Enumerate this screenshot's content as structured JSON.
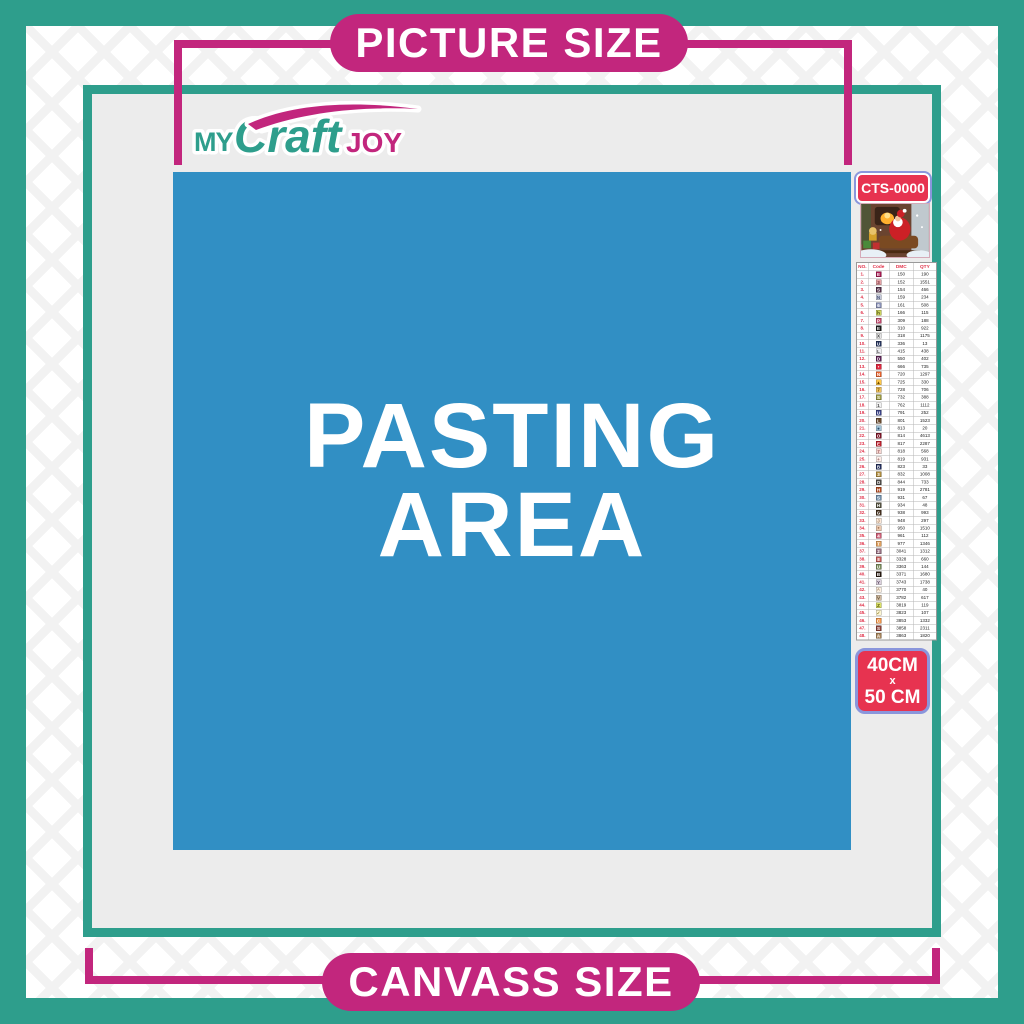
{
  "banners": {
    "top": "PICTURE SIZE",
    "bottom": "CANVASS SIZE"
  },
  "logo": {
    "my": "MY",
    "craft": "Craft",
    "joy": "JOY"
  },
  "pasting_area": {
    "line1": "PASTING",
    "line2": "AREA"
  },
  "sidebar": {
    "sku": "CTS-0000",
    "thumbnail_alt": "christmas-santa-sleigh-artwork",
    "size": {
      "line1": "40CM",
      "line2": "x",
      "line3": "50 CM"
    },
    "table": {
      "headers": [
        "NO.",
        "Code",
        "DMC",
        "QTY"
      ],
      "rows": [
        {
          "no": "1.",
          "symbol": "E",
          "bg": "#a81a52",
          "fg": "#ffffff",
          "dmc": "150",
          "qty": "190"
        },
        {
          "no": "2.",
          "symbol": "3",
          "bg": "#e5a3a6",
          "fg": "#7a3a44",
          "dmc": "152",
          "qty": "1551"
        },
        {
          "no": "3.",
          "symbol": "S",
          "bg": "#53304a",
          "fg": "#ffffff",
          "dmc": "154",
          "qty": "466"
        },
        {
          "no": "4.",
          "symbol": "N",
          "bg": "#c6cbdc",
          "fg": "#4a5578",
          "dmc": "159",
          "qty": "234"
        },
        {
          "no": "5.",
          "symbol": "6",
          "bg": "#8a92b8",
          "fg": "#ffffff",
          "dmc": "161",
          "qty": "508"
        },
        {
          "no": "6.",
          "symbol": "h",
          "bg": "#ccd45e",
          "fg": "#4a4a12",
          "dmc": "166",
          "qty": "115"
        },
        {
          "no": "7.",
          "symbol": "P",
          "bg": "#c24a6e",
          "fg": "#ffffff",
          "dmc": "309",
          "qty": "188"
        },
        {
          "no": "8.",
          "symbol": "E",
          "bg": "#1c1c1c",
          "fg": "#ffffff",
          "dmc": "310",
          "qty": "922"
        },
        {
          "no": "9.",
          "symbol": "X",
          "bg": "#e4e4e4",
          "fg": "#333333",
          "dmc": "318",
          "qty": "1175"
        },
        {
          "no": "10.",
          "symbol": "U",
          "bg": "#27355e",
          "fg": "#ffffff",
          "dmc": "336",
          "qty": "13"
        },
        {
          "no": "11.",
          "symbol": "L",
          "bg": "#eeeef2",
          "fg": "#444444",
          "dmc": "415",
          "qty": "438"
        },
        {
          "no": "12.",
          "symbol": "D",
          "bg": "#5e2458",
          "fg": "#ffffff",
          "dmc": "550",
          "qty": "402"
        },
        {
          "no": "13.",
          "symbol": "•",
          "bg": "#e02840",
          "fg": "#ffffff",
          "dmc": "666",
          "qty": "735"
        },
        {
          "no": "14.",
          "symbol": "N",
          "bg": "#e8622c",
          "fg": "#ffffff",
          "dmc": "720",
          "qty": "1297"
        },
        {
          "no": "15.",
          "symbol": "▲",
          "bg": "#ffc84a",
          "fg": "#6a4a00",
          "dmc": "725",
          "qty": "330"
        },
        {
          "no": "16.",
          "symbol": "7",
          "bg": "#eec05c",
          "fg": "#6a4a00",
          "dmc": "728",
          "qty": "706"
        },
        {
          "no": "17.",
          "symbol": "S",
          "bg": "#9c9a42",
          "fg": "#ffffff",
          "dmc": "732",
          "qty": "388"
        },
        {
          "no": "18.",
          "symbol": "1",
          "bg": "#f2f2f2",
          "fg": "#444444",
          "dmc": "762",
          "qty": "1112"
        },
        {
          "no": "19.",
          "symbol": "U",
          "bg": "#3c4488",
          "fg": "#ffffff",
          "dmc": "791",
          "qty": "252"
        },
        {
          "no": "20.",
          "symbol": "L",
          "bg": "#6a4a2e",
          "fg": "#ffffff",
          "dmc": "801",
          "qty": "1523"
        },
        {
          "no": "21.",
          "symbol": "●",
          "bg": "#a2c4d8",
          "fg": "#2a4a6a",
          "dmc": "813",
          "qty": "20"
        },
        {
          "no": "22.",
          "symbol": "O",
          "bg": "#7e1426",
          "fg": "#ffffff",
          "dmc": "814",
          "qty": "4613"
        },
        {
          "no": "23.",
          "symbol": "E",
          "bg": "#c0202e",
          "fg": "#ffffff",
          "dmc": "817",
          "qty": "2287"
        },
        {
          "no": "24.",
          "symbol": "7",
          "bg": "#f8d8d4",
          "fg": "#9a5a5a",
          "dmc": "818",
          "qty": "568"
        },
        {
          "no": "25.",
          "symbol": "+",
          "bg": "#fdede8",
          "fg": "#9a6a6a",
          "dmc": "819",
          "qty": "931"
        },
        {
          "no": "26.",
          "symbol": "B",
          "bg": "#232f5c",
          "fg": "#ffffff",
          "dmc": "823",
          "qty": "33"
        },
        {
          "no": "27.",
          "symbol": "3",
          "bg": "#b08d3e",
          "fg": "#ffffff",
          "dmc": "832",
          "qty": "1008"
        },
        {
          "no": "28.",
          "symbol": "O",
          "bg": "#4d4a47",
          "fg": "#ffffff",
          "dmc": "844",
          "qty": "733"
        },
        {
          "no": "29.",
          "symbol": "H",
          "bg": "#b04a20",
          "fg": "#ffffff",
          "dmc": "919",
          "qty": "2781"
        },
        {
          "no": "30.",
          "symbol": "S",
          "bg": "#7090ac",
          "fg": "#ffffff",
          "dmc": "931",
          "qty": "67"
        },
        {
          "no": "31.",
          "symbol": "H",
          "bg": "#565442",
          "fg": "#ffffff",
          "dmc": "934",
          "qty": "48"
        },
        {
          "no": "32.",
          "symbol": "G",
          "bg": "#44301e",
          "fg": "#ffffff",
          "dmc": "938",
          "qty": "993"
        },
        {
          "no": "33.",
          "symbol": "J",
          "bg": "#fce8d8",
          "fg": "#9a7a5a",
          "dmc": "948",
          "qty": "297"
        },
        {
          "no": "34.",
          "symbol": "*",
          "bg": "#eccab0",
          "fg": "#8a5a3a",
          "dmc": "950",
          "qty": "1510"
        },
        {
          "no": "35.",
          "symbol": "4",
          "bg": "#d06078",
          "fg": "#ffffff",
          "dmc": "961",
          "qty": "112"
        },
        {
          "no": "36.",
          "symbol": "T",
          "bg": "#e0a05e",
          "fg": "#ffffff",
          "dmc": "977",
          "qty": "1346"
        },
        {
          "no": "37.",
          "symbol": "2",
          "bg": "#967082",
          "fg": "#ffffff",
          "dmc": "3041",
          "qty": "1312"
        },
        {
          "no": "38.",
          "symbol": "8",
          "bg": "#c45a58",
          "fg": "#ffffff",
          "dmc": "3328",
          "qty": "660"
        },
        {
          "no": "39.",
          "symbol": "U",
          "bg": "#7a8c5c",
          "fg": "#ffffff",
          "dmc": "3363",
          "qty": "144"
        },
        {
          "no": "40.",
          "symbol": "B",
          "bg": "#281a10",
          "fg": "#ffffff",
          "dmc": "3371",
          "qty": "1680"
        },
        {
          "no": "41.",
          "symbol": "Y",
          "bg": "#dcd2de",
          "fg": "#5a4a62",
          "dmc": "3743",
          "qty": "1738"
        },
        {
          "no": "42.",
          "symbol": "^",
          "bg": "#fcf0e2",
          "fg": "#8a6a4a",
          "dmc": "3770",
          "qty": "40"
        },
        {
          "no": "43.",
          "symbol": "V",
          "bg": "#d2bca2",
          "fg": "#5a4a32",
          "dmc": "3782",
          "qty": "617"
        },
        {
          "no": "44.",
          "symbol": "Z",
          "bg": "#dce268",
          "fg": "#55550f",
          "dmc": "3819",
          "qty": "119"
        },
        {
          "no": "45.",
          "symbol": "✓",
          "bg": "#fdf6d2",
          "fg": "#8a7a2a",
          "dmc": "3823",
          "qty": "107"
        },
        {
          "no": "46.",
          "symbol": "C",
          "bg": "#f0964a",
          "fg": "#ffffff",
          "dmc": "3853",
          "qty": "1332"
        },
        {
          "no": "47.",
          "symbol": "S",
          "bg": "#8a4038",
          "fg": "#ffffff",
          "dmc": "3858",
          "qty": "2311"
        },
        {
          "no": "48.",
          "symbol": "A",
          "bg": "#a8845a",
          "fg": "#ffffff",
          "dmc": "3863",
          "qty": "1820"
        }
      ]
    }
  },
  "colors": {
    "teal": "#2E9E8C",
    "magenta": "#C2267D",
    "blue": "#318FC4",
    "panel": "#ECECEC",
    "badge-red": "#E73350",
    "badge-border": "#8A96DC",
    "table-red": "#E03048"
  }
}
